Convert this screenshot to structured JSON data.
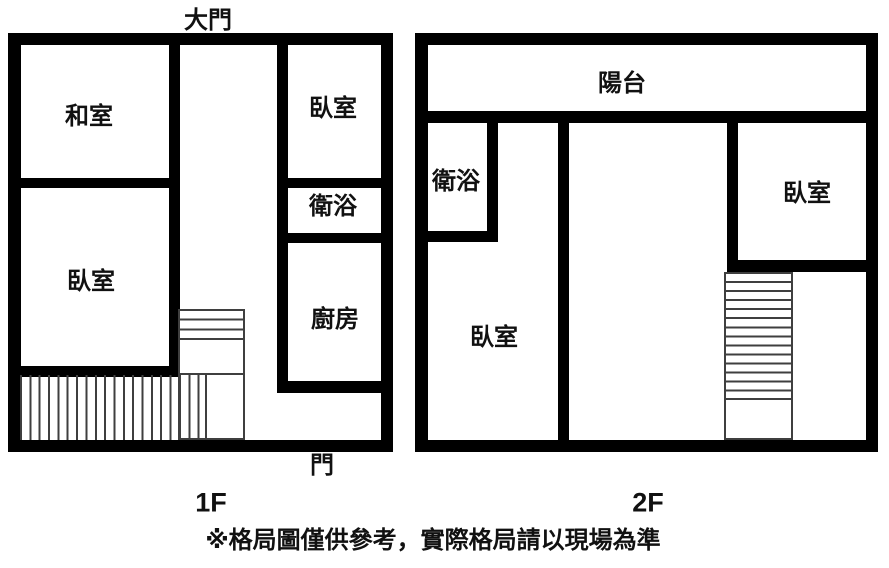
{
  "colors": {
    "wall": "#000000",
    "background": "#ffffff",
    "stair_line": "#3f3f3f",
    "text": "#111111"
  },
  "floor1": {
    "name": "1F",
    "entrance_label": "大門",
    "door_label": "門",
    "rooms": {
      "washitsu": "和室",
      "bedroom_left": "臥室",
      "bedroom_right": "臥室",
      "bathroom": "衛浴",
      "kitchen": "廚房"
    }
  },
  "floor2": {
    "name": "2F",
    "rooms": {
      "balcony": "陽台",
      "bathroom": "衛浴",
      "bedroom_main": "臥室",
      "bedroom_right": "臥室"
    }
  },
  "disclaimer": "※格局圖僅供參考，實際格局請以現場為準"
}
